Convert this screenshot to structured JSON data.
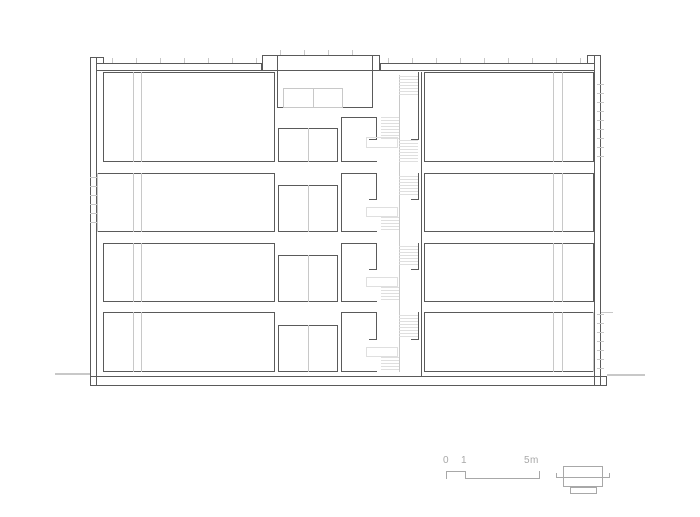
{
  "colors": {
    "bg": "#ffffff",
    "line_dark": "#5a5a5a",
    "line_light": "#c8c8c8",
    "line_faint": "#dfdfdf",
    "annotation_gray": "#a8a8a8"
  },
  "canvas": {
    "width": 700,
    "height": 517
  },
  "scale_bar": {
    "zero": "0",
    "one": "1",
    "five": "5m"
  },
  "drawing": {
    "shapes": [
      {
        "name": "left-exterior-wall",
        "type": "rect",
        "x": 90,
        "y": 57,
        "w": 7,
        "h": 329,
        "stroke": "dark"
      },
      {
        "name": "left-parapet-cap",
        "type": "hline",
        "x": 96,
        "y": 57,
        "w": 8,
        "stroke": "dark"
      },
      {
        "name": "left-parapet-inner-face",
        "type": "vline",
        "x": 103,
        "y": 57,
        "h": 7,
        "stroke": "dark"
      },
      {
        "name": "right-exterior-wall",
        "type": "rect",
        "x": 594,
        "y": 55,
        "w": 7,
        "h": 331,
        "stroke": "dark"
      },
      {
        "name": "right-parapet-cap",
        "type": "hline",
        "x": 587,
        "y": 55,
        "w": 8,
        "stroke": "dark"
      },
      {
        "name": "right-parapet-inner-face",
        "type": "vline",
        "x": 587,
        "y": 55,
        "h": 9,
        "stroke": "dark"
      },
      {
        "name": "roof-slab-left",
        "type": "rect",
        "x": 96,
        "y": 63,
        "w": 166,
        "h": 8,
        "stroke": "dark"
      },
      {
        "name": "roof-slab-right",
        "type": "rect",
        "x": 380,
        "y": 63,
        "w": 215,
        "h": 8,
        "stroke": "dark"
      },
      {
        "name": "stair-bulkhead-cap",
        "type": "rect",
        "x": 262,
        "y": 55,
        "w": 118,
        "h": 16,
        "stroke": "dark"
      },
      {
        "name": "bulkhead-wall-left",
        "type": "vline",
        "x": 277,
        "y": 55,
        "h": 53,
        "stroke": "dark"
      },
      {
        "name": "bulkhead-wall-right",
        "type": "vline",
        "x": 372,
        "y": 55,
        "h": 53,
        "stroke": "dark"
      },
      {
        "name": "bulkhead-floor-line",
        "type": "hline",
        "x": 277,
        "y": 107,
        "w": 96,
        "stroke": "dark"
      },
      {
        "name": "bulkhead-skylight",
        "type": "rect",
        "x": 283,
        "y": 88,
        "w": 60,
        "h": 20,
        "stroke": "light"
      },
      {
        "name": "bulkhead-skylight-divider",
        "type": "vline",
        "x": 313,
        "y": 88,
        "h": 20,
        "stroke": "light"
      },
      {
        "name": "roof-insulation-ticks-left",
        "type": "hticks",
        "x": 112,
        "y": 58,
        "w": 148,
        "h": 5
      },
      {
        "name": "roof-insulation-ticks-bulkhead",
        "type": "hticks",
        "x": 280,
        "y": 50,
        "w": 90,
        "h": 5
      },
      {
        "name": "roof-insulation-ticks-right",
        "type": "hticks",
        "x": 388,
        "y": 58,
        "w": 200,
        "h": 5
      },
      {
        "name": "foundation-slab",
        "type": "rect",
        "x": 90,
        "y": 376,
        "w": 517,
        "h": 10,
        "stroke": "dark"
      },
      {
        "name": "ground-line-left",
        "type": "hline",
        "x": 55,
        "y": 373,
        "w": 35,
        "thick": 2,
        "stroke": "light"
      },
      {
        "name": "ground-line-right",
        "type": "hline",
        "x": 607,
        "y": 374,
        "w": 38,
        "thick": 2,
        "stroke": "light"
      },
      {
        "name": "grade-tick-right",
        "type": "hline",
        "x": 601,
        "y": 312,
        "w": 12,
        "stroke": "light"
      },
      {
        "name": "room-left-floor1",
        "type": "rect",
        "x": 103,
        "y": 72,
        "w": 172,
        "h": 90,
        "stroke": "dark"
      },
      {
        "name": "room-left-floor2",
        "type": "rect",
        "x": 97,
        "y": 173,
        "w": 178,
        "h": 59,
        "stroke": "dark",
        "sides": "trb"
      },
      {
        "name": "room-left-floor2-window-edge",
        "type": "vline",
        "x": 97,
        "y": 173,
        "h": 59,
        "stroke": "light"
      },
      {
        "name": "room-left-floor3",
        "type": "rect",
        "x": 103,
        "y": 243,
        "w": 172,
        "h": 59,
        "stroke": "dark"
      },
      {
        "name": "room-left-floor4",
        "type": "rect",
        "x": 103,
        "y": 312,
        "w": 172,
        "h": 60,
        "stroke": "dark"
      },
      {
        "name": "shaft-line-left-f1-a",
        "type": "vline",
        "x": 133,
        "y": 72,
        "h": 90,
        "stroke": "light"
      },
      {
        "name": "shaft-line-left-f1-b",
        "type": "vline",
        "x": 141,
        "y": 72,
        "h": 90,
        "stroke": "light"
      },
      {
        "name": "shaft-line-left-f2-a",
        "type": "vline",
        "x": 133,
        "y": 173,
        "h": 59,
        "stroke": "light"
      },
      {
        "name": "shaft-line-left-f2-b",
        "type": "vline",
        "x": 141,
        "y": 173,
        "h": 59,
        "stroke": "light"
      },
      {
        "name": "shaft-line-left-f3-a",
        "type": "vline",
        "x": 133,
        "y": 243,
        "h": 59,
        "stroke": "light"
      },
      {
        "name": "shaft-line-left-f3-b",
        "type": "vline",
        "x": 141,
        "y": 243,
        "h": 59,
        "stroke": "light"
      },
      {
        "name": "shaft-line-left-f4-a",
        "type": "vline",
        "x": 133,
        "y": 312,
        "h": 60,
        "stroke": "light"
      },
      {
        "name": "shaft-line-left-f4-b",
        "type": "vline",
        "x": 141,
        "y": 312,
        "h": 60,
        "stroke": "light"
      },
      {
        "name": "core-room-floor1",
        "type": "rect",
        "x": 278,
        "y": 128,
        "w": 60,
        "h": 34,
        "stroke": "dark"
      },
      {
        "name": "core-room-floor1-divider",
        "type": "vline",
        "x": 308,
        "y": 128,
        "h": 34,
        "stroke": "light"
      },
      {
        "name": "core-room-floor2",
        "type": "rect",
        "x": 278,
        "y": 185,
        "w": 60,
        "h": 47,
        "stroke": "dark"
      },
      {
        "name": "core-room-floor2-divider",
        "type": "vline",
        "x": 308,
        "y": 185,
        "h": 47,
        "stroke": "light"
      },
      {
        "name": "core-room-floor3",
        "type": "rect",
        "x": 278,
        "y": 255,
        "w": 60,
        "h": 47,
        "stroke": "dark"
      },
      {
        "name": "core-room-floor3-divider",
        "type": "vline",
        "x": 308,
        "y": 255,
        "h": 47,
        "stroke": "light"
      },
      {
        "name": "core-room-floor4",
        "type": "rect",
        "x": 278,
        "y": 325,
        "w": 60,
        "h": 47,
        "stroke": "dark"
      },
      {
        "name": "core-room-floor4-divider",
        "type": "vline",
        "x": 308,
        "y": 325,
        "h": 47,
        "stroke": "light"
      },
      {
        "name": "stair-hall-floor1",
        "type": "rect",
        "x": 341,
        "y": 117,
        "w": 36,
        "h": 45,
        "stroke": "dark",
        "sides": "tlb"
      },
      {
        "name": "stair-door-wall-floor1",
        "type": "vline",
        "x": 376,
        "y": 117,
        "h": 22,
        "stroke": "dark"
      },
      {
        "name": "stair-door-lintel-floor1",
        "type": "hline",
        "x": 369,
        "y": 139,
        "w": 8,
        "stroke": "dark"
      },
      {
        "name": "stair-hall-floor2",
        "type": "rect",
        "x": 341,
        "y": 173,
        "w": 36,
        "h": 59,
        "stroke": "dark",
        "sides": "tlb"
      },
      {
        "name": "stair-door-wall-floor2",
        "type": "vline",
        "x": 376,
        "y": 173,
        "h": 26,
        "stroke": "dark"
      },
      {
        "name": "stair-door-lintel-floor2",
        "type": "hline",
        "x": 369,
        "y": 199,
        "w": 8,
        "stroke": "dark"
      },
      {
        "name": "stair-hall-floor3",
        "type": "rect",
        "x": 341,
        "y": 243,
        "w": 36,
        "h": 59,
        "stroke": "dark",
        "sides": "tlb"
      },
      {
        "name": "stair-door-wall-floor3",
        "type": "vline",
        "x": 376,
        "y": 243,
        "h": 26,
        "stroke": "dark"
      },
      {
        "name": "stair-door-lintel-floor3",
        "type": "hline",
        "x": 369,
        "y": 269,
        "w": 8,
        "stroke": "dark"
      },
      {
        "name": "stair-hall-floor4",
        "type": "rect",
        "x": 341,
        "y": 312,
        "w": 36,
        "h": 60,
        "stroke": "dark",
        "sides": "tlb"
      },
      {
        "name": "stair-door-wall-floor4",
        "type": "vline",
        "x": 376,
        "y": 312,
        "h": 27,
        "stroke": "dark"
      },
      {
        "name": "stair-door-lintel-floor4",
        "type": "hline",
        "x": 369,
        "y": 339,
        "w": 8,
        "stroke": "dark"
      },
      {
        "name": "stair-wall-right-seg-f1",
        "type": "vline",
        "x": 418,
        "y": 72,
        "h": 67,
        "stroke": "dark"
      },
      {
        "name": "stair-wall-right-hook-f1",
        "type": "hline",
        "x": 411,
        "y": 139,
        "w": 8,
        "stroke": "dark"
      },
      {
        "name": "stair-wall-right-seg-f2",
        "type": "vline",
        "x": 418,
        "y": 173,
        "h": 26,
        "stroke": "dark"
      },
      {
        "name": "stair-wall-right-hook-f2",
        "type": "hline",
        "x": 411,
        "y": 199,
        "w": 8,
        "stroke": "dark"
      },
      {
        "name": "stair-wall-right-seg-f3",
        "type": "vline",
        "x": 418,
        "y": 243,
        "h": 26,
        "stroke": "dark"
      },
      {
        "name": "stair-wall-right-hook-f3",
        "type": "hline",
        "x": 411,
        "y": 269,
        "w": 8,
        "stroke": "dark"
      },
      {
        "name": "stair-wall-right-seg-f4",
        "type": "vline",
        "x": 418,
        "y": 312,
        "h": 27,
        "stroke": "dark"
      },
      {
        "name": "stair-wall-right-hook-f4",
        "type": "hline",
        "x": 411,
        "y": 339,
        "w": 8,
        "stroke": "dark"
      },
      {
        "name": "stair-core-party-wall",
        "type": "vline",
        "x": 421,
        "y": 72,
        "h": 304,
        "stroke": "dark"
      },
      {
        "name": "room-right-floor1",
        "type": "rect",
        "x": 424,
        "y": 72,
        "w": 170,
        "h": 90,
        "stroke": "dark"
      },
      {
        "name": "room-right-floor2",
        "type": "rect",
        "x": 424,
        "y": 173,
        "w": 170,
        "h": 59,
        "stroke": "dark"
      },
      {
        "name": "room-right-floor3",
        "type": "rect",
        "x": 424,
        "y": 243,
        "w": 170,
        "h": 59,
        "stroke": "dark"
      },
      {
        "name": "room-right-floor4",
        "type": "rect",
        "x": 424,
        "y": 312,
        "w": 170,
        "h": 60,
        "stroke": "dark",
        "sides": "tlb"
      },
      {
        "name": "room-right-floor4-window-edge",
        "type": "vline",
        "x": 593,
        "y": 312,
        "h": 60,
        "stroke": "light"
      },
      {
        "name": "shaft-line-right-f1-a",
        "type": "vline",
        "x": 553,
        "y": 72,
        "h": 90,
        "stroke": "light"
      },
      {
        "name": "shaft-line-right-f1-b",
        "type": "vline",
        "x": 562,
        "y": 72,
        "h": 90,
        "stroke": "light"
      },
      {
        "name": "shaft-line-right-f2-a",
        "type": "vline",
        "x": 553,
        "y": 173,
        "h": 59,
        "stroke": "light"
      },
      {
        "name": "shaft-line-right-f2-b",
        "type": "vline",
        "x": 562,
        "y": 173,
        "h": 59,
        "stroke": "light"
      },
      {
        "name": "shaft-line-right-f3-a",
        "type": "vline",
        "x": 553,
        "y": 243,
        "h": 59,
        "stroke": "light"
      },
      {
        "name": "shaft-line-right-f3-b",
        "type": "vline",
        "x": 562,
        "y": 243,
        "h": 59,
        "stroke": "light"
      },
      {
        "name": "shaft-line-right-f4-a",
        "type": "vline",
        "x": 553,
        "y": 312,
        "h": 60,
        "stroke": "light"
      },
      {
        "name": "shaft-line-right-f4-b",
        "type": "vline",
        "x": 562,
        "y": 312,
        "h": 60,
        "stroke": "light"
      },
      {
        "name": "window-mullion-ticks-left-f2",
        "type": "vticks",
        "x": 90,
        "y": 177,
        "w": 7,
        "h": 53
      },
      {
        "name": "window-mullion-ticks-right-f1",
        "type": "vticks",
        "x": 597,
        "y": 84,
        "w": 7,
        "h": 77
      },
      {
        "name": "window-mullion-ticks-right-f4",
        "type": "vticks",
        "x": 597,
        "y": 314,
        "w": 7,
        "h": 57
      },
      {
        "name": "stair-center-line",
        "type": "vline",
        "x": 399,
        "y": 75,
        "h": 297,
        "stroke": "light"
      },
      {
        "name": "stair-flight-f1-upper",
        "type": "hatch",
        "x": 399,
        "y": 76,
        "w": 19,
        "h": 21
      },
      {
        "name": "stair-flight-f1-mid",
        "type": "hatch",
        "x": 381,
        "y": 117,
        "w": 18,
        "h": 23
      },
      {
        "name": "stair-flight-f1-lower",
        "type": "hatch",
        "x": 399,
        "y": 140,
        "w": 19,
        "h": 22
      },
      {
        "name": "stair-landing-f1",
        "type": "rect",
        "x": 366,
        "y": 137,
        "w": 32,
        "h": 11,
        "stroke": "faint"
      },
      {
        "name": "stair-flight-f2-upper",
        "type": "hatch",
        "x": 399,
        "y": 176,
        "w": 19,
        "h": 21
      },
      {
        "name": "stair-landing-f2",
        "type": "rect",
        "x": 366,
        "y": 207,
        "w": 32,
        "h": 10,
        "stroke": "faint"
      },
      {
        "name": "stair-flight-f2-lower",
        "type": "hatch",
        "x": 381,
        "y": 217,
        "w": 18,
        "h": 15
      },
      {
        "name": "stair-flight-f3-upper",
        "type": "hatch",
        "x": 399,
        "y": 246,
        "w": 19,
        "h": 21
      },
      {
        "name": "stair-landing-f3",
        "type": "rect",
        "x": 366,
        "y": 277,
        "w": 32,
        "h": 10,
        "stroke": "faint"
      },
      {
        "name": "stair-flight-f3-lower",
        "type": "hatch",
        "x": 381,
        "y": 287,
        "w": 18,
        "h": 15
      },
      {
        "name": "stair-flight-f4-upper",
        "type": "hatch",
        "x": 399,
        "y": 315,
        "w": 19,
        "h": 22
      },
      {
        "name": "stair-landing-f4",
        "type": "rect",
        "x": 366,
        "y": 347,
        "w": 32,
        "h": 10,
        "stroke": "faint"
      },
      {
        "name": "stair-flight-f4-lower",
        "type": "hatch",
        "x": 381,
        "y": 357,
        "w": 18,
        "h": 15
      },
      {
        "name": "scale-bar-tick-0",
        "type": "vline",
        "x": 446,
        "y": 471,
        "h": 8,
        "stroke": "gray"
      },
      {
        "name": "scale-bar-segment-0-1",
        "type": "hline",
        "x": 446,
        "y": 471,
        "w": 20,
        "stroke": "gray"
      },
      {
        "name": "scale-bar-tick-1",
        "type": "vline",
        "x": 465,
        "y": 471,
        "h": 8,
        "stroke": "gray"
      },
      {
        "name": "scale-bar-segment-1-5",
        "type": "hline",
        "x": 465,
        "y": 478,
        "w": 75,
        "stroke": "gray"
      },
      {
        "name": "scale-bar-tick-5",
        "type": "vline",
        "x": 539,
        "y": 471,
        "h": 8,
        "stroke": "gray"
      },
      {
        "name": "key-plan-outline",
        "type": "rect",
        "x": 563,
        "y": 466,
        "w": 40,
        "h": 21,
        "stroke": "gray"
      },
      {
        "name": "key-plan-annex",
        "type": "rect",
        "x": 570,
        "y": 487,
        "w": 27,
        "h": 7,
        "stroke": "gray"
      },
      {
        "name": "key-plan-section-line",
        "type": "hline",
        "x": 556,
        "y": 477,
        "w": 54,
        "stroke": "gray"
      },
      {
        "name": "key-plan-section-hook-left",
        "type": "vline",
        "x": 556,
        "y": 473,
        "h": 5,
        "stroke": "gray"
      },
      {
        "name": "key-plan-section-hook-right",
        "type": "vline",
        "x": 609,
        "y": 473,
        "h": 5,
        "stroke": "gray"
      }
    ]
  }
}
